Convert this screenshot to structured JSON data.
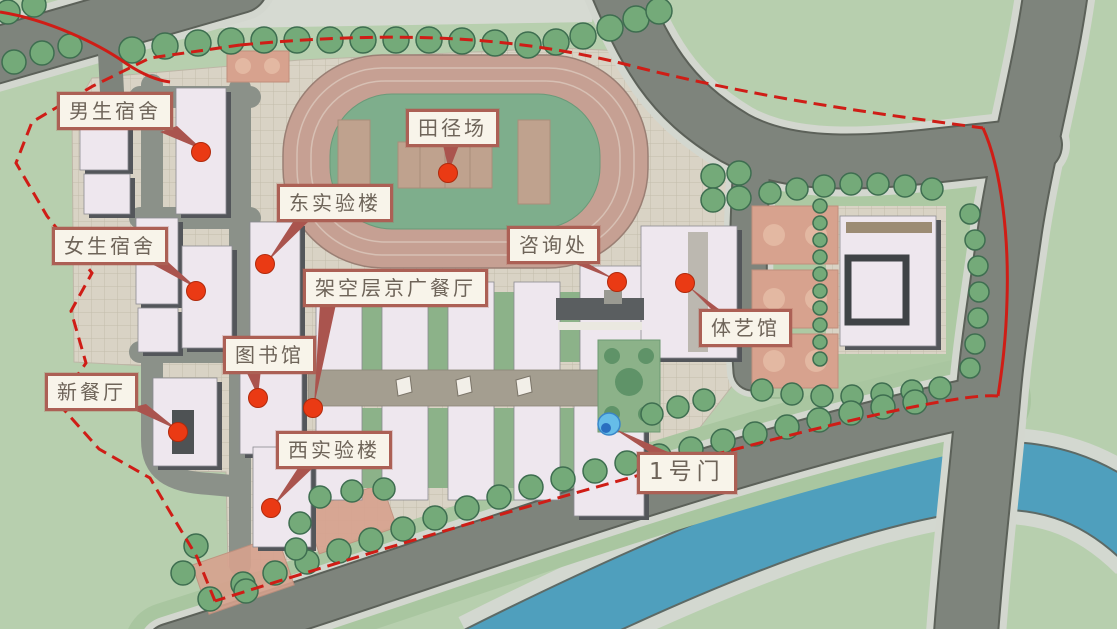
{
  "map": {
    "type": "campus-master-plan",
    "labels": [
      {
        "id": "boys-dorm",
        "text": "男生宿舍"
      },
      {
        "id": "track-field",
        "text": "田径场"
      },
      {
        "id": "east-lab",
        "text": "东实验楼"
      },
      {
        "id": "girls-dorm",
        "text": "女生宿舍"
      },
      {
        "id": "consultation",
        "text": "咨询处"
      },
      {
        "id": "stilt-canteen",
        "text": "架空层京广餐厅"
      },
      {
        "id": "library",
        "text": "图书馆"
      },
      {
        "id": "gym",
        "text": "体艺馆"
      },
      {
        "id": "new-canteen",
        "text": "新餐厅"
      },
      {
        "id": "west-lab",
        "text": "西实验楼"
      },
      {
        "id": "gate-1",
        "text": "1号门"
      }
    ],
    "markers": {
      "building_marker": "red-dot",
      "gate_marker": "blue-dot"
    },
    "palette": {
      "grass": "#b7cfae",
      "paving": "#d9d3c5",
      "road": "#7e847c",
      "sidewalk": "#d3d7cf",
      "water": "#4f9fbd",
      "track_ring": "#c6a093",
      "track_infield": "#7eae8c",
      "building": "#eee7ee",
      "building_shadow": "#53565a",
      "tree": "#74aa79",
      "court": "#d7a28e",
      "boundary_red": "#cf1d16",
      "dot_red": "#ea3a14",
      "label_border": "#ac6055",
      "label_bg": "#f8f4ea",
      "label_text": "#6e6459",
      "gate_marker_blue": "#66bde8"
    }
  }
}
